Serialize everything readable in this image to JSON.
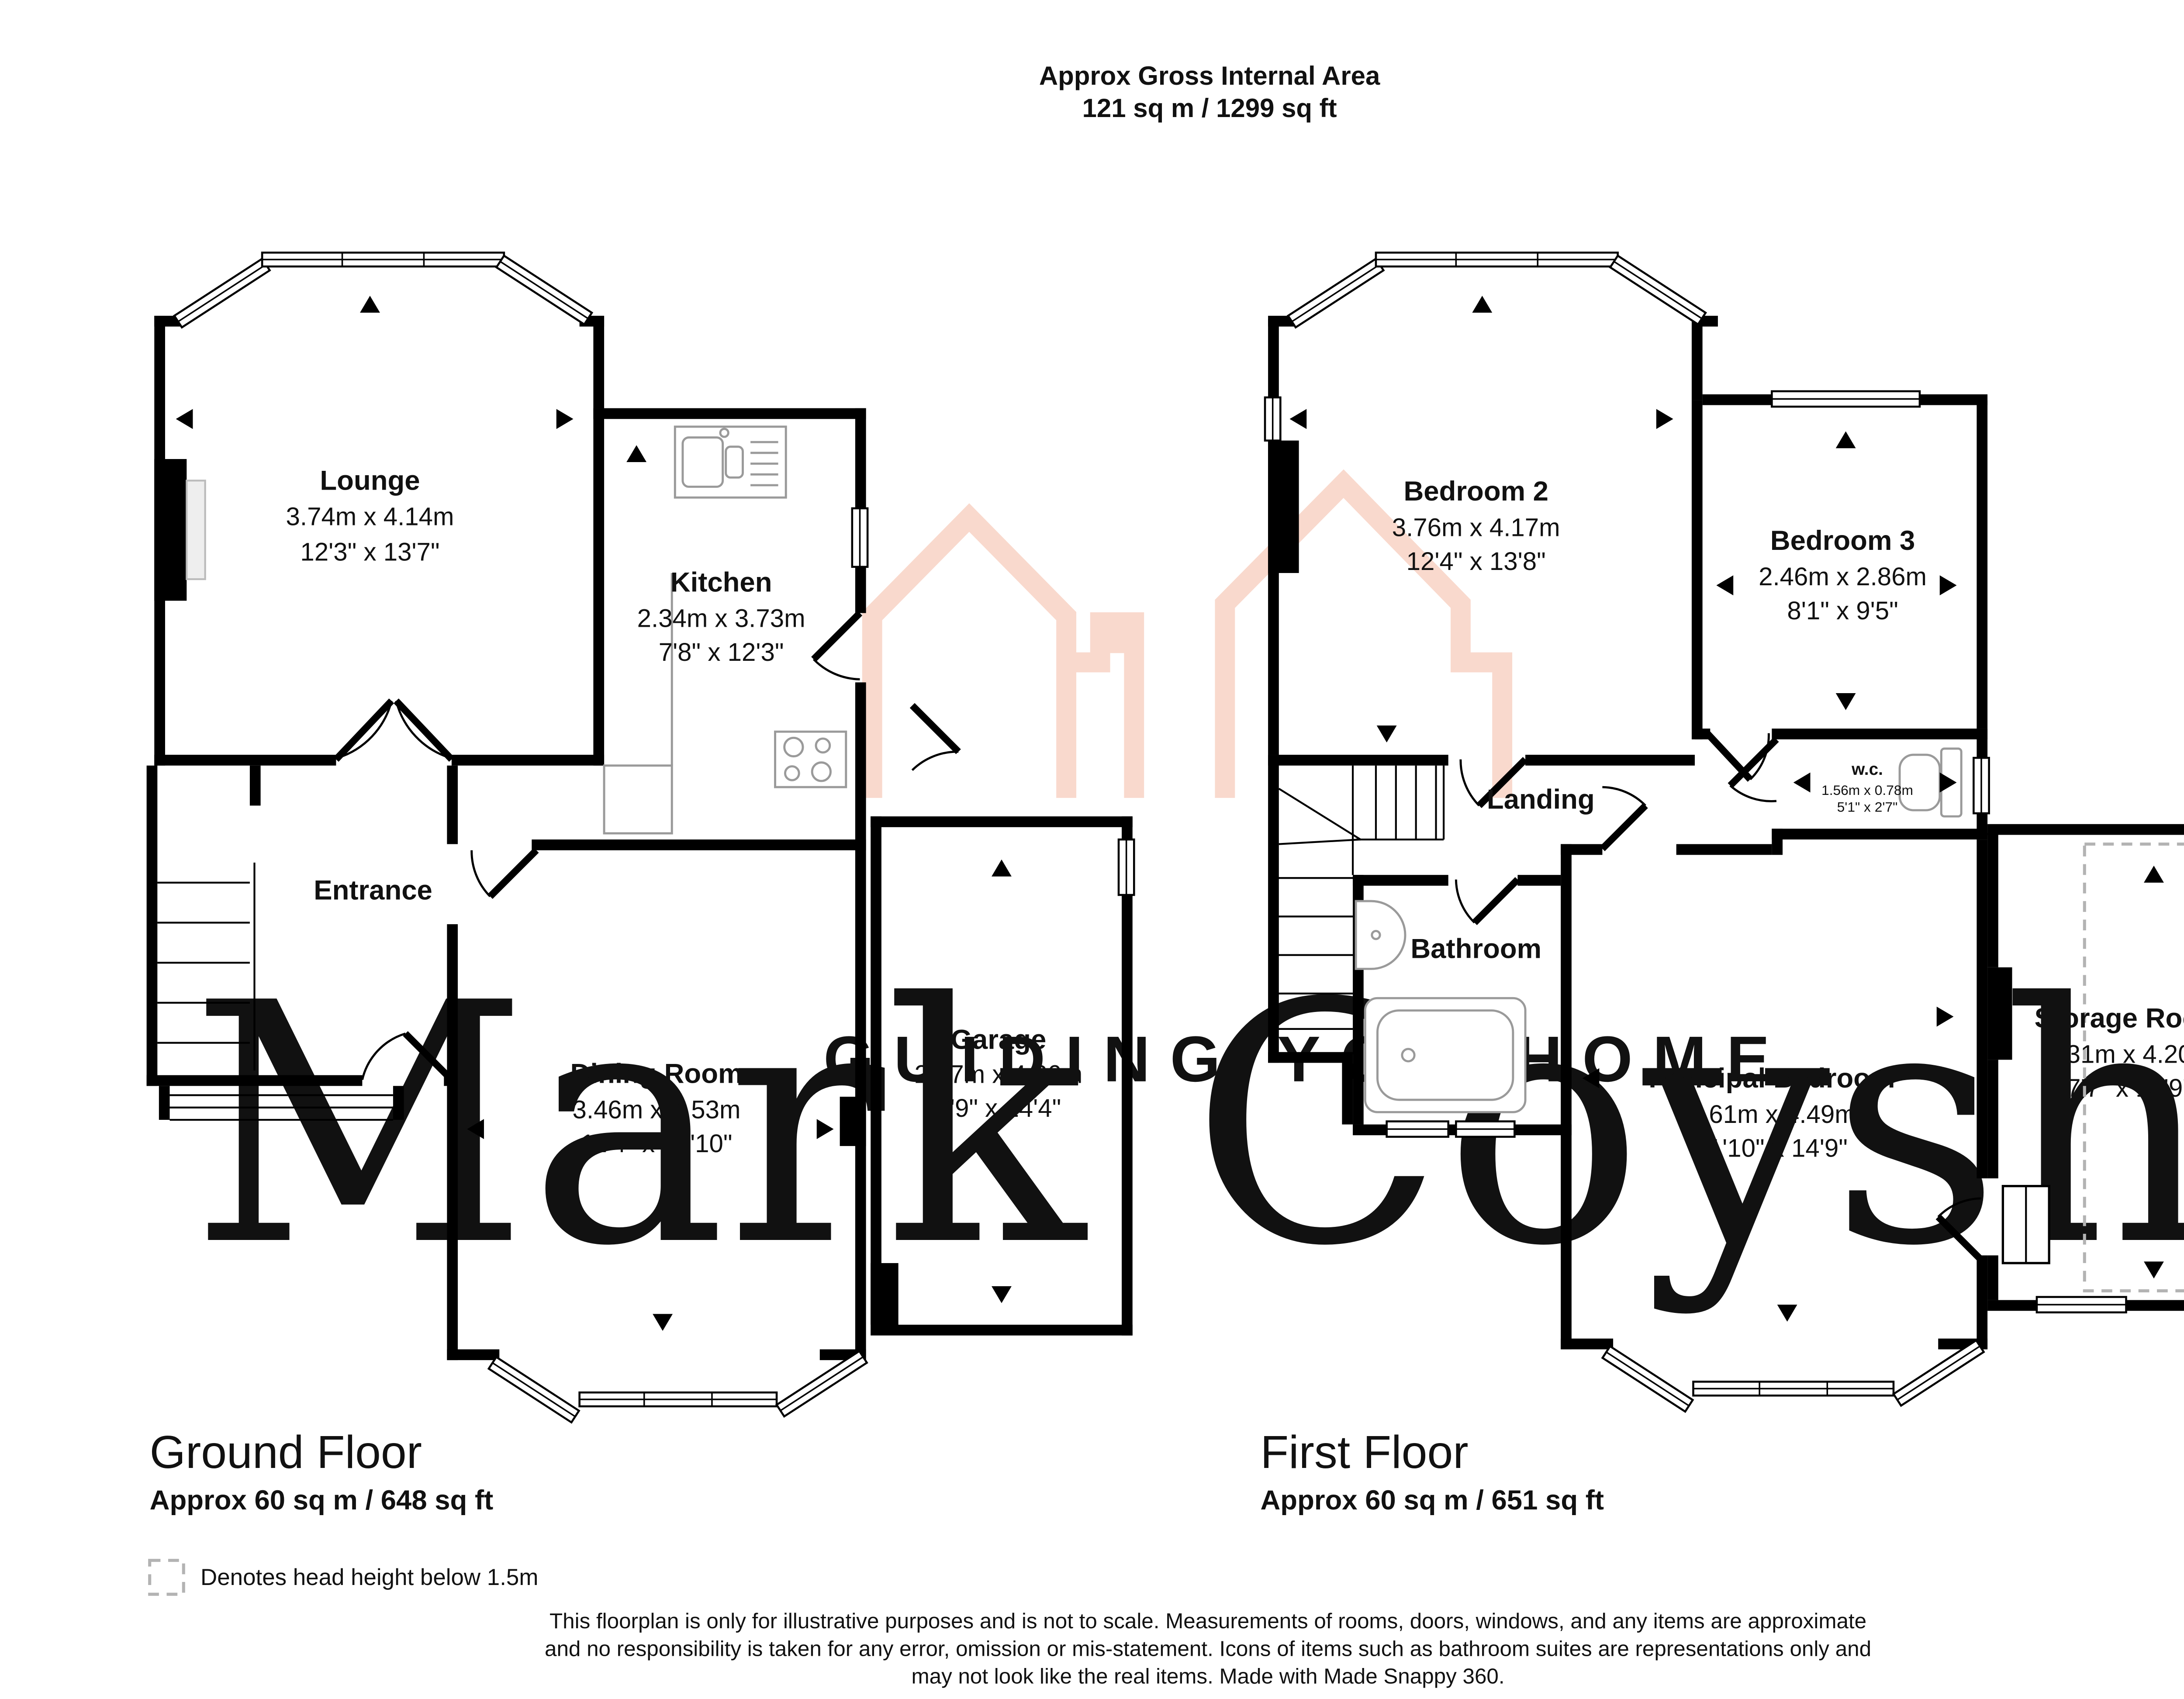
{
  "title": {
    "line1": "Approx Gross Internal Area",
    "line2": "121 sq m / 1299 sq ft"
  },
  "watermark": {
    "name": "Mark Coysh",
    "tagline": "GUIDING YOU HOME"
  },
  "ground_floor": {
    "label": "Ground Floor",
    "area": "Approx 60 sq m / 648 sq ft",
    "rooms": {
      "lounge": {
        "name": "Lounge",
        "metric": "3.74m x 4.14m",
        "imperial": "12'3\" x 13'7\""
      },
      "kitchen": {
        "name": "Kitchen",
        "metric": "2.34m x 3.73m",
        "imperial": "7'8\" x 12'3\""
      },
      "entrance": {
        "name": "Entrance"
      },
      "dining": {
        "name": "Dining Room",
        "metric": "3.46m x 4.53m",
        "imperial": "11'4\" x 14'10\""
      },
      "garage": {
        "name": "Garage",
        "metric": "2.37m x 4.36m",
        "imperial": "7'9\" x 14'4\""
      }
    }
  },
  "first_floor": {
    "label": "First Floor",
    "area": "Approx 60 sq m / 651 sq ft",
    "rooms": {
      "bedroom2": {
        "name": "Bedroom 2",
        "metric": "3.76m x 4.17m",
        "imperial": "12'4\" x 13'8\""
      },
      "bedroom3": {
        "name": "Bedroom 3",
        "metric": "2.46m x 2.86m",
        "imperial": "8'1\" x 9'5\""
      },
      "landing": {
        "name": "Landing"
      },
      "wc": {
        "name": "w.c.",
        "metric": "1.56m x 0.78m",
        "imperial": "5'1\" x 2'7\""
      },
      "bathroom": {
        "name": "Bathroom"
      },
      "principal": {
        "name": "Principal Bedroom",
        "metric": "3.61m x 4.49m",
        "imperial": "11'10\" x 14'9\""
      },
      "storage": {
        "name": "Storage Room",
        "metric": "2.31m x 4.20m",
        "imperial": "7'7\" x 13'9\""
      }
    }
  },
  "legend": {
    "head_height": "Denotes head height below 1.5m"
  },
  "disclaimer": {
    "line1": "This floorplan is only for illustrative purposes and is not to scale. Measurements of rooms, doors, windows, and any items are approximate",
    "line2": "and no responsibility is taken for any error, omission or mis-statement. Icons of items such as bathroom suites are representations only and",
    "line3": "may not look like the real items. Made with Made Snappy 360."
  },
  "colors": {
    "wall": "#000000",
    "fixture": "#9a9a9a",
    "watermark_text": "#f3f0ec",
    "brand_pink": "#f6cabb",
    "logo_pink": "#f9d9cd",
    "dashed_grey": "#b3b3b3"
  }
}
